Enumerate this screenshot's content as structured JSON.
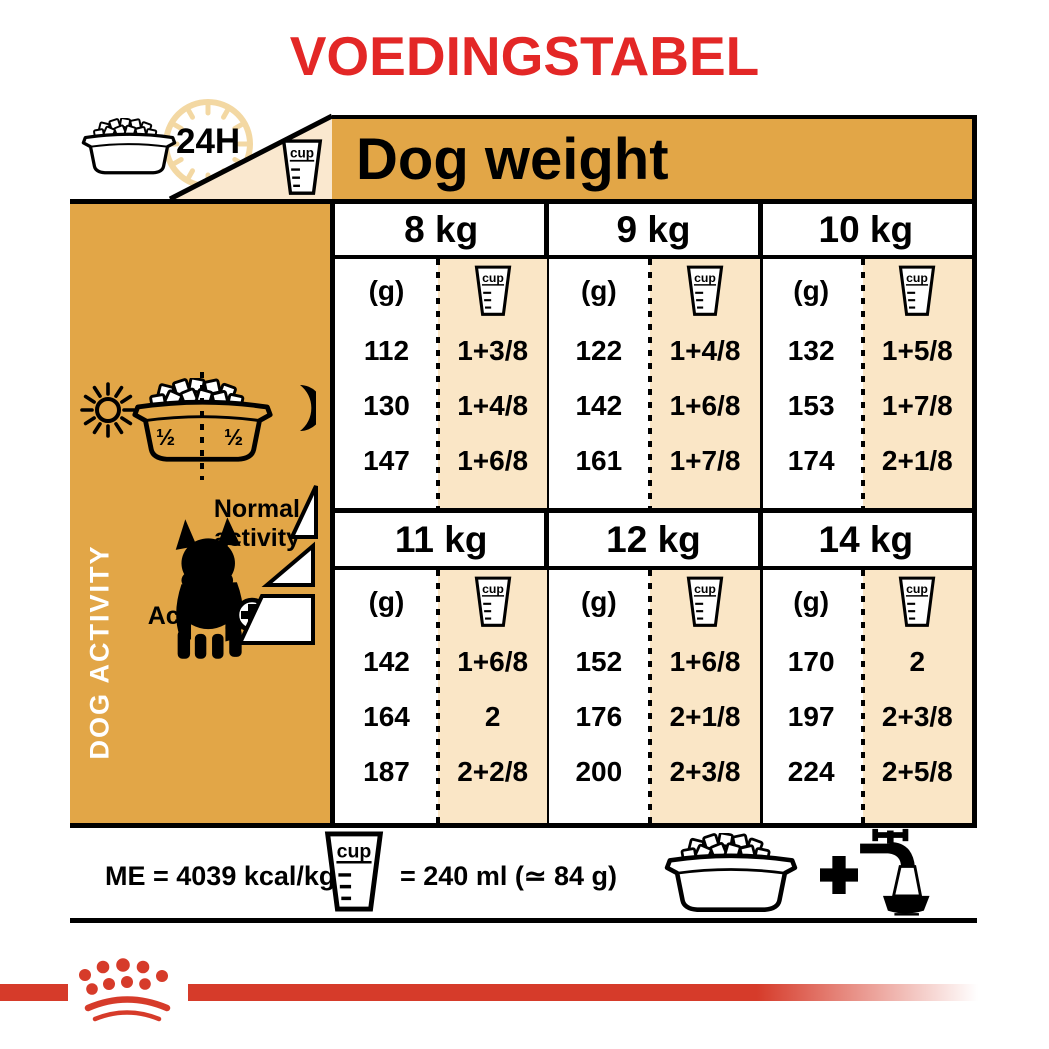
{
  "title": "VOEDINGSTABEL",
  "header": {
    "hours_label": "24H",
    "dog_weight_label": "Dog weight"
  },
  "labels": {
    "cup": "cup",
    "gram": "(g)"
  },
  "sidebar": {
    "vertical_label": "DOG ACTIVITY",
    "bowl_half_left": "½",
    "bowl_half_right": "½",
    "normal_activity_label": "Normal activity",
    "activity_label": "Activity"
  },
  "table": {
    "blocks": [
      {
        "columns": [
          {
            "weight": "8 kg",
            "rows": [
              [
                "112",
                "1+3/8"
              ],
              [
                "130",
                "1+4/8"
              ],
              [
                "147",
                "1+6/8"
              ]
            ]
          },
          {
            "weight": "9 kg",
            "rows": [
              [
                "122",
                "1+4/8"
              ],
              [
                "142",
                "1+6/8"
              ],
              [
                "161",
                "1+7/8"
              ]
            ]
          },
          {
            "weight": "10 kg",
            "rows": [
              [
                "132",
                "1+5/8"
              ],
              [
                "153",
                "1+7/8"
              ],
              [
                "174",
                "2+1/8"
              ]
            ]
          }
        ]
      },
      {
        "columns": [
          {
            "weight": "11 kg",
            "rows": [
              [
                "142",
                "1+6/8"
              ],
              [
                "164",
                "2"
              ],
              [
                "187",
                "2+2/8"
              ]
            ]
          },
          {
            "weight": "12 kg",
            "rows": [
              [
                "152",
                "1+6/8"
              ],
              [
                "176",
                "2+1/8"
              ],
              [
                "200",
                "2+3/8"
              ]
            ]
          },
          {
            "weight": "14 kg",
            "rows": [
              [
                "170",
                "2"
              ],
              [
                "197",
                "2+3/8"
              ],
              [
                "224",
                "2+5/8"
              ]
            ]
          }
        ]
      }
    ]
  },
  "footer": {
    "me_label": "ME = 4039 kcal/kg",
    "cup_equals_label": "= 240 ml (≃ 84 g)"
  },
  "colors": {
    "accent_orange": "#E2A647",
    "cream": "#FAE6C6",
    "title_red": "#E32726",
    "brand_red": "#D63B2A"
  },
  "chart_data": {
    "type": "table",
    "title": "VOEDINGSTABEL",
    "column_group_label": "Dog weight",
    "units": [
      "g",
      "cup"
    ],
    "cup_definition": "cup = 240 ml (≃ 84 g)",
    "metabolizable_energy": "ME = 4039 kcal/kg",
    "row_axis": "dog activity (normal → activity +)",
    "weights_kg": [
      8,
      9,
      10,
      11,
      12,
      14
    ],
    "series": [
      {
        "weight": "8 kg",
        "grams": [
          112,
          130,
          147
        ],
        "cups": [
          "1+3/8",
          "1+4/8",
          "1+6/8"
        ]
      },
      {
        "weight": "9 kg",
        "grams": [
          122,
          142,
          161
        ],
        "cups": [
          "1+4/8",
          "1+6/8",
          "1+7/8"
        ]
      },
      {
        "weight": "10 kg",
        "grams": [
          132,
          153,
          174
        ],
        "cups": [
          "1+5/8",
          "1+7/8",
          "2+1/8"
        ]
      },
      {
        "weight": "11 kg",
        "grams": [
          142,
          164,
          187
        ],
        "cups": [
          "1+6/8",
          "2",
          "2+2/8"
        ]
      },
      {
        "weight": "12 kg",
        "grams": [
          152,
          176,
          200
        ],
        "cups": [
          "1+6/8",
          "2+1/8",
          "2+3/8"
        ]
      },
      {
        "weight": "14 kg",
        "grams": [
          170,
          197,
          224
        ],
        "cups": [
          "2",
          "2+3/8",
          "2+5/8"
        ]
      }
    ]
  }
}
